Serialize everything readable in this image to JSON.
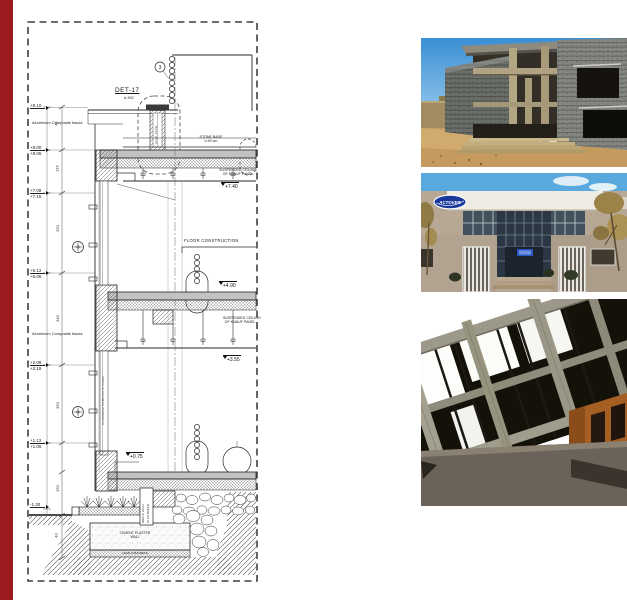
{
  "page": {
    "colors": {
      "accent_bar": "#9c1b1e",
      "logo_blue": "#18399b",
      "sky_blue": "#4a9fd8",
      "render_orange": "#a55f22"
    }
  },
  "drawing": {
    "det_label": "DET-17",
    "det_ref": "A-902",
    "bubble_number": "3",
    "labels": {
      "fascia_upper": "Aluminium Composite fascia",
      "fascia_lower": "Aluminium Composite fascia",
      "stone_base_1": "STONE BASE",
      "stone_base_2": "t=40 cm",
      "susp_ceiling_1a": "SUSPENDED CEILING",
      "susp_ceiling_1b": "OF KNAUF PANEL",
      "susp_ceiling_2a": "SUSPENDED CEILING",
      "susp_ceiling_2b": "OF KNAUF PANEL",
      "floor_construction": "FLOOR CONSTRUCTION",
      "brick_wall_a": "BRICK WALL",
      "brick_wall_b": "PLASTERED",
      "foundation_a": "CEMENT PLASTER",
      "foundation_b": "WALL",
      "lean_concrete": "LEAN CONCRETE",
      "mullion_note": "ALUMINIUM COMPOSITE PANEL",
      "det_note": "ALUM. PANEL"
    },
    "levels_right": {
      "l740": "+7.40",
      "l490": "+4.90",
      "l355": "+3.55",
      "l075": "+0.75"
    },
    "levels_left": [
      {
        "top": "+9.10",
        "bottom": ""
      },
      {
        "top": "+8.00",
        "bottom": "+8.05"
      },
      {
        "top": "+7.08",
        "bottom": "+7.15"
      },
      {
        "top": "+5.12",
        "bottom": "+5.06"
      },
      {
        "top": "+2.08",
        "bottom": "+2.15"
      },
      {
        "top": "+1.12",
        "bottom": "+1.06"
      },
      {
        "top": "-1.30",
        "bottom": ""
      }
    ],
    "dims": [
      "41",
      "115",
      "250",
      "340",
      "350",
      "150",
      "40"
    ]
  },
  "photos": {
    "office": {
      "logo_text": "ACTOVER"
    }
  }
}
